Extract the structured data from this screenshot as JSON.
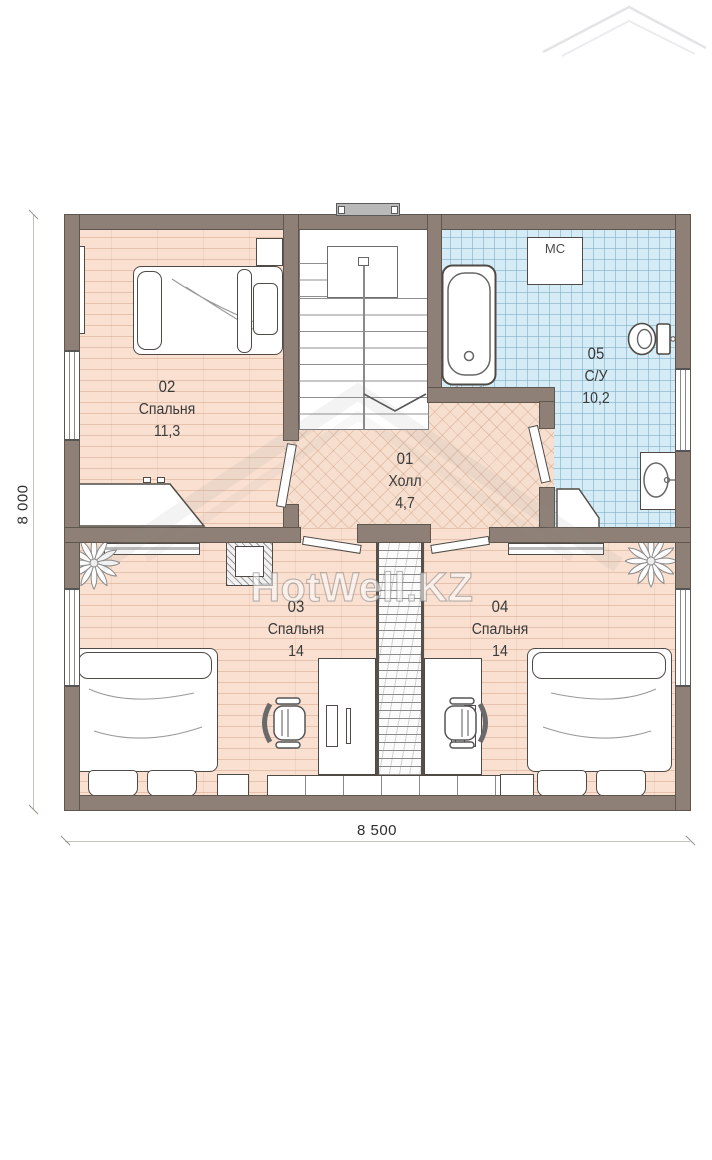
{
  "rooms": {
    "hall": {
      "number": "01",
      "name": "Холл",
      "area": "4,7"
    },
    "bedroom_top": {
      "number": "02",
      "name": "Спальня",
      "area": "11,3"
    },
    "bedroom_left": {
      "number": "03",
      "name": "Спальня",
      "area": "14"
    },
    "bedroom_right": {
      "number": "04",
      "name": "Спальня",
      "area": "14"
    },
    "bathroom": {
      "number": "05",
      "name": "С/У",
      "area": "10,2"
    }
  },
  "fixtures": {
    "washing_machine_label": "МС"
  },
  "dimensions": {
    "overall_width": "8 500",
    "overall_depth": "8 000"
  },
  "watermark": {
    "text": "HotWell.KZ"
  },
  "colors": {
    "wall": "#8e8076",
    "room_floor": "#f9e0d1",
    "hall_floor": "#f7dfcf",
    "tile_floor": "#d5ebf5"
  }
}
